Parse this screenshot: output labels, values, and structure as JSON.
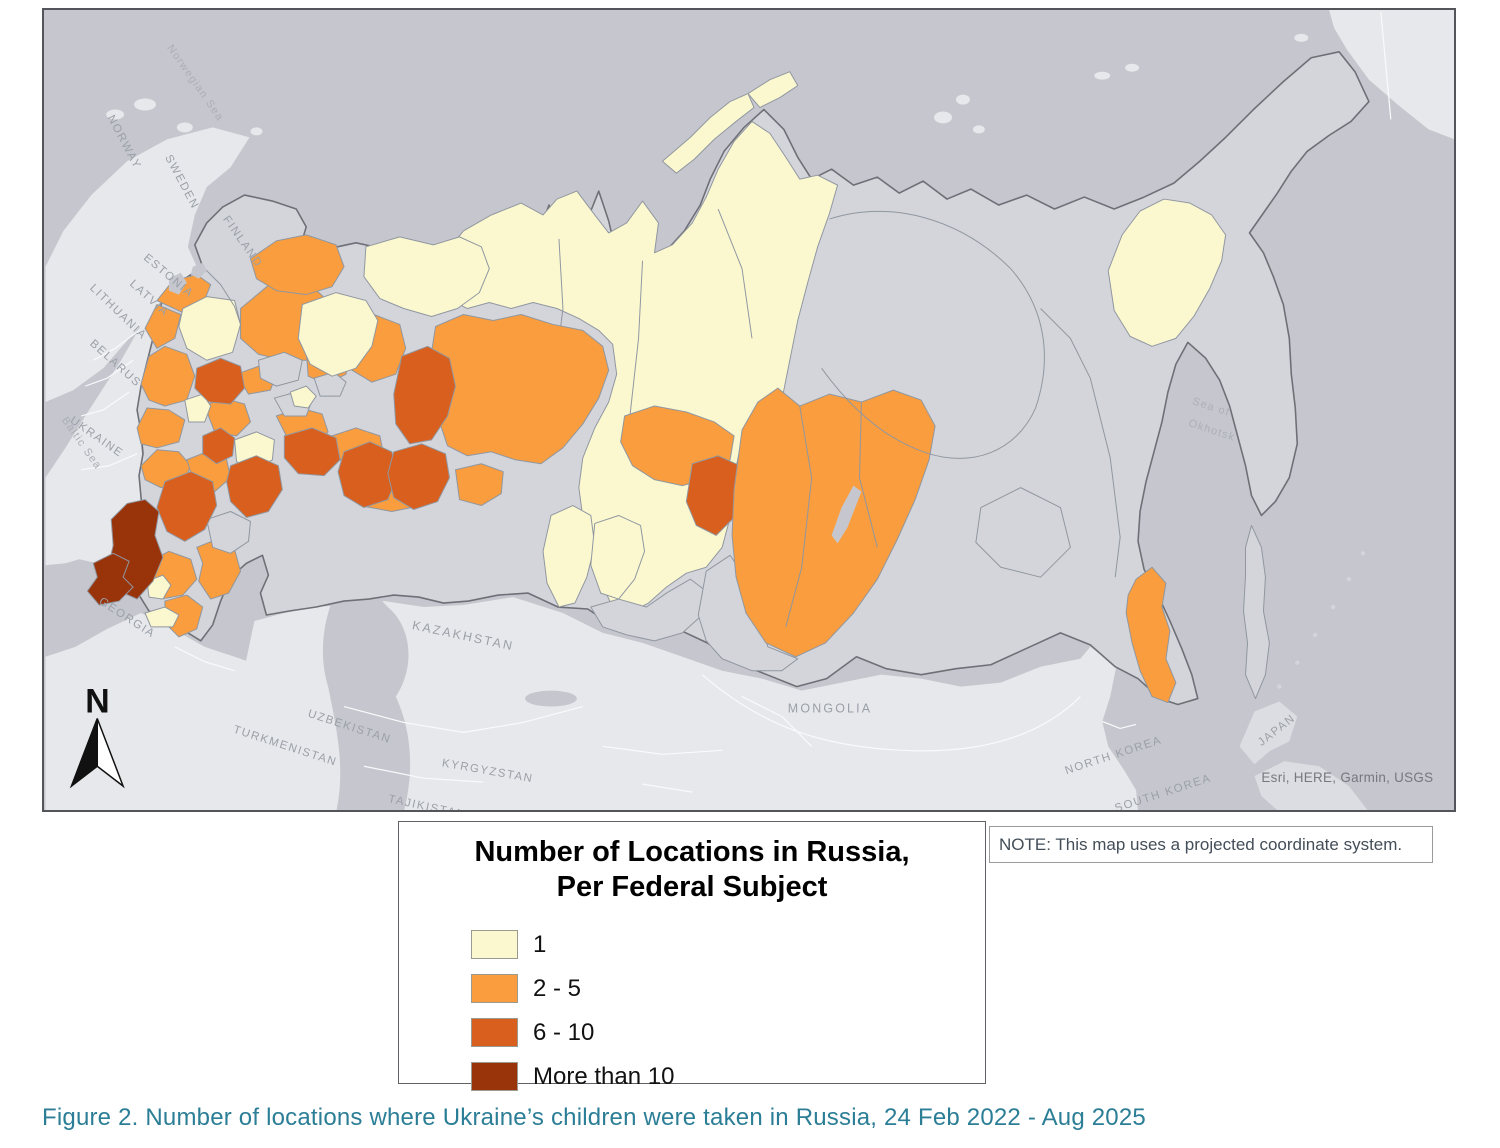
{
  "figure": {
    "caption": "Figure 2. Number of locations where Ukraine’s children were taken in Russia, 24 Feb 2022 - Aug 2025"
  },
  "note": {
    "text": "NOTE: This map uses a projected coordinate system."
  },
  "map_frame": {
    "attribution": "Esri, HERE, Garmin, USGS",
    "north_label": "N"
  },
  "legend": {
    "title_line1": "Number of Locations in Russia,",
    "title_line2": "Per Federal Subject",
    "items": [
      {
        "label": "1",
        "color": "#FBF8D0"
      },
      {
        "label": "2 - 5",
        "color": "#F99D3E"
      },
      {
        "label": "6 - 10",
        "color": "#D95F1E"
      },
      {
        "label": "More than 10",
        "color": "#99330A"
      }
    ]
  },
  "map": {
    "colors": {
      "ocean": "#c6c7ce",
      "land": "#e7e8eb",
      "land2": "#dcdde2",
      "nodata": "#d4d5db",
      "class1": "#FBF8D0",
      "class2": "#F99D3E",
      "class3": "#D95F1E",
      "class4": "#99330A",
      "subjborder": "#9097a0",
      "ruborder": "#6f7077",
      "cborder": "#fafafc",
      "label": "#9aa0a8",
      "sealabel": "#abafb7"
    },
    "country_labels": [
      "NORWAY",
      "SWEDEN",
      "FINLAND",
      "ESTONIA",
      "LATVIA",
      "LITHUANIA",
      "BELARUS",
      "UKRAINE",
      "GEORGIA",
      "KAZAKHSTAN",
      "UZBEKISTAN",
      "TURKMENISTAN",
      "KYRGYZSTAN",
      "TAJIKISTAN",
      "MONGOLIA",
      "NORTH KOREA",
      "SOUTH KOREA",
      "JAPAN"
    ],
    "sea_labels": {
      "norwegian": "Norwegian Sea",
      "baltic": "Baltic Sea",
      "okhotsk1": "Sea of",
      "okhotsk2": "Okhotsk"
    }
  }
}
